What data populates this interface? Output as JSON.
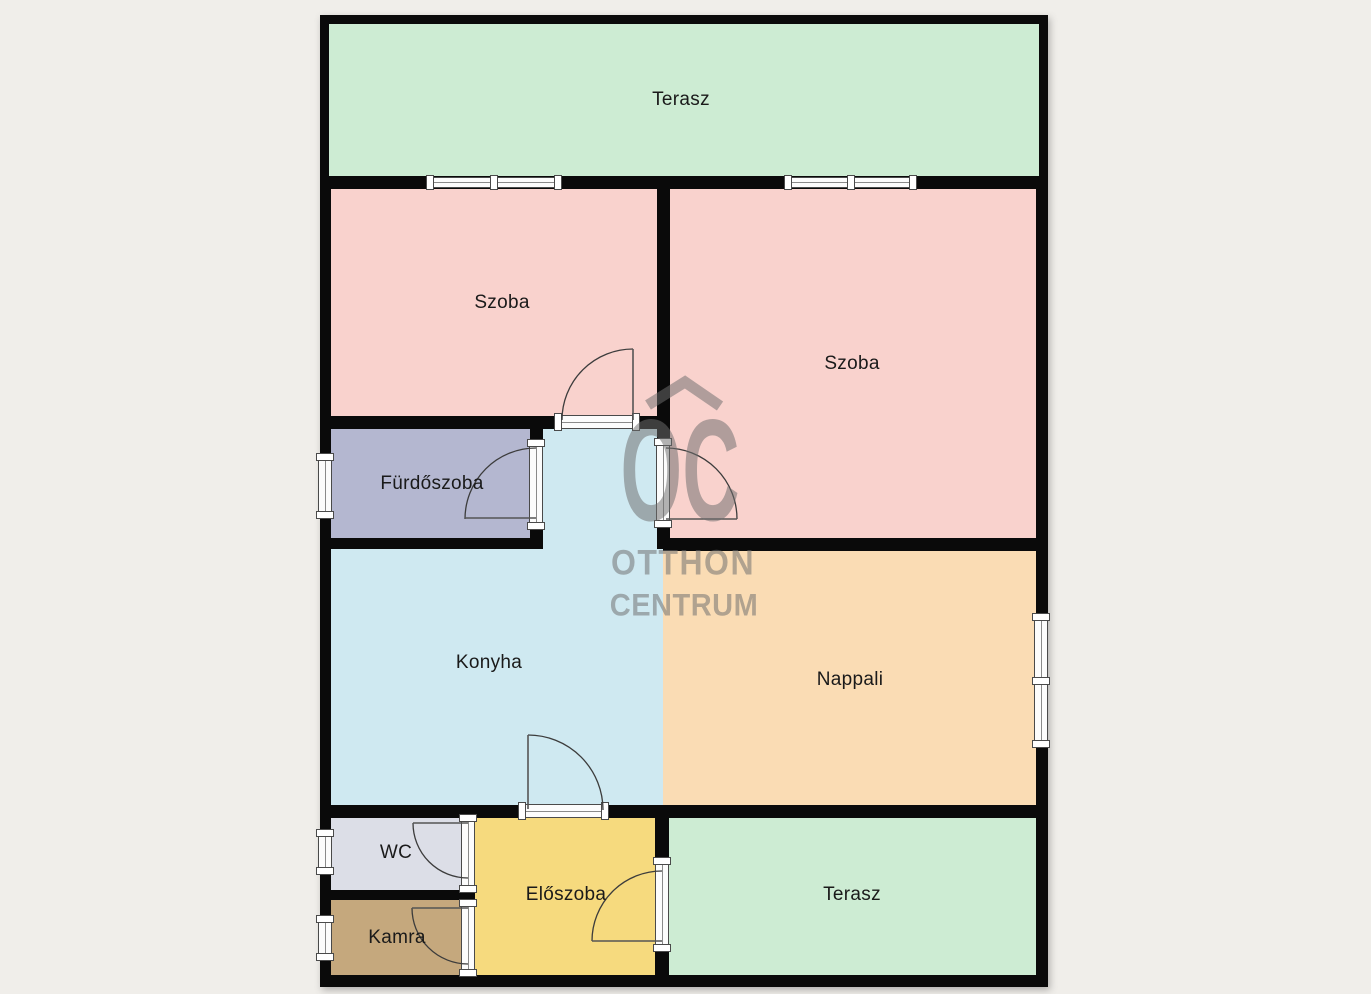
{
  "stage": {
    "width": 1371,
    "height": 994,
    "background": "#f0eeea"
  },
  "palette": {
    "wall": "#0a0a0a",
    "frame_fill": "#fcfcfc",
    "frame_stroke": "#4a4a4a",
    "label_color": "#1a1a1a",
    "swing_color": "#3c3c3c"
  },
  "watermark": {
    "logo_text": "OC",
    "line1": "OTTHON",
    "line2": "CENTRUM",
    "color": "#6e6e6e"
  },
  "plan": {
    "x": 320,
    "y": 15,
    "w": 728,
    "h": 972
  },
  "rooms": [
    {
      "id": "terasz-top",
      "label": "Terasz",
      "color": "#cdecd3",
      "x": 329,
      "y": 24,
      "w": 710,
      "h": 152,
      "lx": 681,
      "ly": 100
    },
    {
      "id": "szoba-left",
      "label": "Szoba",
      "color": "#f9d2cd",
      "x": 331,
      "y": 189,
      "w": 326,
      "h": 227,
      "lx": 502,
      "ly": 303
    },
    {
      "id": "szoba-right",
      "label": "Szoba",
      "color": "#f9d2cd",
      "x": 670,
      "y": 189,
      "w": 366,
      "h": 349,
      "lx": 852,
      "ly": 364
    },
    {
      "id": "furdoszoba",
      "label": "Fürdőszoba",
      "color": "#b4b7d0",
      "x": 331,
      "y": 429,
      "w": 199,
      "h": 109,
      "lx": 432,
      "ly": 484
    },
    {
      "id": "konyha-ext",
      "label": "",
      "color": "#cfe9f1",
      "x": 543,
      "y": 429,
      "w": 114,
      "h": 120,
      "lx": 0,
      "ly": 0
    },
    {
      "id": "konyha",
      "label": "Konyha",
      "color": "#cfe9f1",
      "x": 331,
      "y": 549,
      "w": 332,
      "h": 256,
      "lx": 489,
      "ly": 663
    },
    {
      "id": "nappali",
      "label": "Nappali",
      "color": "#fadcb4",
      "x": 663,
      "y": 551,
      "w": 373,
      "h": 254,
      "lx": 850,
      "ly": 680
    },
    {
      "id": "wc",
      "label": "WC",
      "color": "#dcdee7",
      "x": 331,
      "y": 818,
      "w": 131,
      "h": 72,
      "lx": 396,
      "ly": 853
    },
    {
      "id": "kamra",
      "label": "Kamra",
      "color": "#c5a87d",
      "x": 331,
      "y": 900,
      "w": 131,
      "h": 75,
      "lx": 397,
      "ly": 938
    },
    {
      "id": "eloszoba",
      "label": "Előszoba",
      "color": "#f6da7e",
      "x": 475,
      "y": 818,
      "w": 180,
      "h": 157,
      "lx": 566,
      "ly": 895
    },
    {
      "id": "terasz-bottom",
      "label": "Terasz",
      "color": "#cdecd3",
      "x": 669,
      "y": 818,
      "w": 367,
      "h": 157,
      "lx": 852,
      "ly": 895
    }
  ],
  "openings": [
    {
      "id": "window-terasz-left",
      "kind": "window",
      "x": 429,
      "y": 177,
      "w": 130,
      "h": 11,
      "o": "h",
      "divider": true
    },
    {
      "id": "window-terasz-right",
      "kind": "window",
      "x": 787,
      "y": 177,
      "w": 127,
      "h": 11,
      "o": "h",
      "divider": true
    },
    {
      "id": "window-furdoszoba",
      "kind": "window",
      "x": 318,
      "y": 456,
      "w": 14,
      "h": 60,
      "o": "v",
      "divider": false
    },
    {
      "id": "window-nappali",
      "kind": "window",
      "x": 1034,
      "y": 616,
      "w": 14,
      "h": 129,
      "o": "v",
      "divider": true
    },
    {
      "id": "window-wc",
      "kind": "window",
      "x": 318,
      "y": 832,
      "w": 14,
      "h": 40,
      "o": "v",
      "divider": false
    },
    {
      "id": "window-kamra",
      "kind": "window",
      "x": 318,
      "y": 918,
      "w": 14,
      "h": 40,
      "o": "v",
      "divider": false
    },
    {
      "id": "door-frame-szoba-left",
      "kind": "door-frame",
      "x": 557,
      "y": 415,
      "w": 80,
      "h": 14,
      "o": "h",
      "divider": false
    },
    {
      "id": "door-frame-furdoszoba",
      "kind": "door-frame",
      "x": 529,
      "y": 442,
      "w": 14,
      "h": 85,
      "o": "v",
      "divider": false
    },
    {
      "id": "door-frame-szoba-right",
      "kind": "door-frame",
      "x": 656,
      "y": 441,
      "w": 14,
      "h": 84,
      "o": "v",
      "divider": false
    },
    {
      "id": "door-frame-konyha",
      "kind": "door-frame",
      "x": 521,
      "y": 804,
      "w": 85,
      "h": 14,
      "o": "h",
      "divider": false
    },
    {
      "id": "door-frame-wc",
      "kind": "door-frame",
      "x": 461,
      "y": 817,
      "w": 14,
      "h": 73,
      "o": "v",
      "divider": false
    },
    {
      "id": "door-frame-kamra",
      "kind": "door-frame",
      "x": 461,
      "y": 902,
      "w": 14,
      "h": 72,
      "o": "v",
      "divider": false
    },
    {
      "id": "door-frame-eloszoba",
      "kind": "door-frame",
      "x": 655,
      "y": 860,
      "w": 14,
      "h": 89,
      "o": "v",
      "divider": false
    }
  ],
  "door_swings": [
    {
      "id": "swing-szoba-left",
      "panel": {
        "x1": 633,
        "y1": 420,
        "x2": 633,
        "y2": 349
      },
      "arc": "M 633 349 A 71 71 0 0 0 562 420"
    },
    {
      "id": "swing-furdoszoba",
      "panel": {
        "x1": 536,
        "y1": 518,
        "x2": 465,
        "y2": 518
      },
      "arc": "M 465 519 A 71 71 0 0 1 536 448"
    },
    {
      "id": "swing-szoba-right",
      "panel": {
        "x1": 666,
        "y1": 519,
        "x2": 737,
        "y2": 519
      },
      "arc": "M 666 448 A 71 71 0 0 1 737 519"
    },
    {
      "id": "swing-konyha",
      "panel": {
        "x1": 528,
        "y1": 809,
        "x2": 528,
        "y2": 735
      },
      "arc": "M 528 735 A 75 75 0 0 1 603 810"
    },
    {
      "id": "swing-wc",
      "panel": {
        "x1": 468,
        "y1": 823,
        "x2": 413,
        "y2": 823
      },
      "arc": "M 413 823 A 55 55 0 0 0 468 878"
    },
    {
      "id": "swing-kamra",
      "panel": {
        "x1": 468,
        "y1": 908,
        "x2": 412,
        "y2": 908
      },
      "arc": "M 412 908 A 56 56 0 0 0 468 964"
    },
    {
      "id": "swing-eloszoba",
      "panel": {
        "x1": 662,
        "y1": 941,
        "x2": 592,
        "y2": 941
      },
      "arc": "M 592 941 A 70 70 0 0 1 662 871"
    }
  ]
}
